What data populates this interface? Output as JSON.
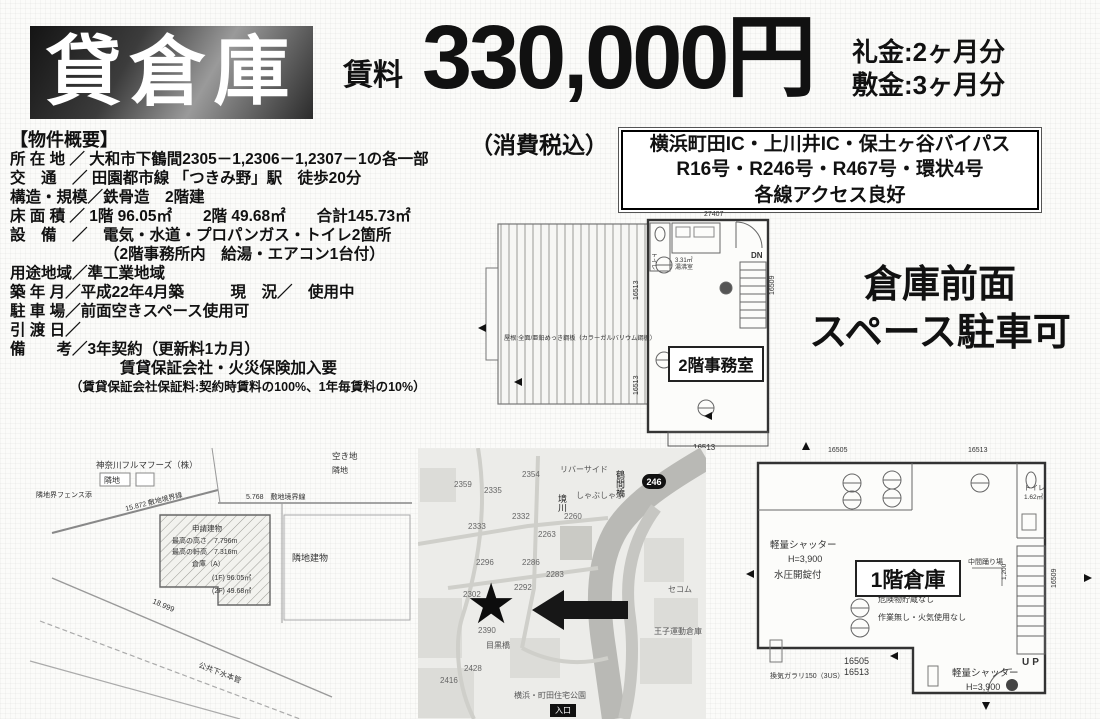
{
  "flyer": {
    "banner": "貸倉庫",
    "rent_label": "賃料",
    "rent_amount": "330,000円",
    "tax_note": "（消費税込）",
    "key_money": "礼金:2ヶ月分",
    "deposit": "敷金:3ヶ月分"
  },
  "access_box": {
    "line1": "横浜町田IC・上川井IC・保土ヶ谷バイパス",
    "line2": "R16号・R246号・R467号・環状4号",
    "line3": "各線アクセス良好"
  },
  "property": {
    "title": "【物件概要】",
    "lines": [
      "所 在 地 ／ 大和市下鶴間2305－1,2306－1,2307－1の各一部",
      "交　通　／ 田園都市線 「つきみ野」駅　徒歩20分",
      "構造・規模／鉄骨造　2階建",
      "床 面 積 ／ 1階 96.05㎡　　2階 49.68㎡　　合計145.73㎡",
      "設　備　／　電気・水道・プロパンガス・トイレ2箇所",
      "（2階事務所内　給湯・エアコン1台付）",
      "用途地域／準工業地域",
      "築 年 月／平成22年4月築　　　現　況／　使用中",
      "駐 車 場／前面空きスペース使用可",
      "引 渡 日／",
      "備　　考／3年契約（更新料1カ月）",
      "賃貸保証会社・火災保険加入要",
      "（賃貸保証会社保証料:契約時賃料の100%、1年毎賃料の10%）"
    ]
  },
  "parking_note": {
    "line1": "倉庫前面",
    "line2": "スペース駐車可"
  },
  "floorplan_2f": {
    "room_label": "2階事務室",
    "toilet_label": "トイレ",
    "kitchen_area": "3.31㎡",
    "kitchen_label": "湯沸室",
    "stairs_label": "DN",
    "roof_note": "屋根:全面/亜鉛めっき鋼板（カラーガルバリウム鋼板）",
    "dim_top": "27407",
    "dim_left_a": "16513",
    "dim_left_b": "16513",
    "dim_right": "16509",
    "dim_bottom": "16513"
  },
  "floorplan_1f": {
    "room_label": "1階倉庫",
    "shutter_left_1": "軽量シャッター",
    "shutter_left_2": "H=3,900",
    "shutter_left_3": "水圧開錠付",
    "note1": "危険物貯蔵なし",
    "note2": "作業無し・火気使用なし",
    "landing_label": "中間踊り場",
    "landing_dim": "1,200",
    "toilet_label": "トイレ",
    "toilet_area": "1.62㎡",
    "stairs_label": "UP",
    "shutter_right_1": "軽量シャッター",
    "shutter_right_2": "H=3,900",
    "vent_note": "換気ガラリ150（3US）",
    "dim_top_a": "16505",
    "dim_top_b": "16513",
    "dim_bottom_1": "16505",
    "dim_bottom_2": "16513",
    "dim_right": "16509"
  },
  "siteplan": {
    "neighbor_top": "神奈川フルマフーズ（株）",
    "neighbor_top_tag": "隣地",
    "vacant_lot": "空き地",
    "vacant_tag": "隣地",
    "fence_note": "隣地界フェンス添",
    "boundary1": "15.872 敷地境界線",
    "boundary2": "5.768　敷地境界線",
    "building_title": "申請建物",
    "building_height": "最高の高さ／7.796m",
    "building_eaves": "最高の軒高／7.316m",
    "building_name": "倉庫（A）",
    "area_1f": "(1F) 96.05㎡",
    "area_2f": "(2F) 49.68㎡",
    "neighbor_right": "隣地建物",
    "road_dim": "18.999",
    "sewer": "公共下水本管"
  },
  "map": {
    "route_badge": "246",
    "bridge": "鶴間橋",
    "river": "境川",
    "riverside": "リバーサイド",
    "restaurant": "しゃぶしゃぶ",
    "bridge2": "目黒橋",
    "housing_park": "横浜・町田住宅公園",
    "warehouse": "王子運動倉庫",
    "secom": "セコム",
    "gate_badge": "入口",
    "lot_numbers": [
      "2354",
      "2359",
      "2335",
      "2332",
      "2333",
      "2260",
      "2263",
      "2296",
      "2286",
      "2283",
      "2292",
      "2302",
      "2390",
      "2428",
      "2416"
    ]
  }
}
